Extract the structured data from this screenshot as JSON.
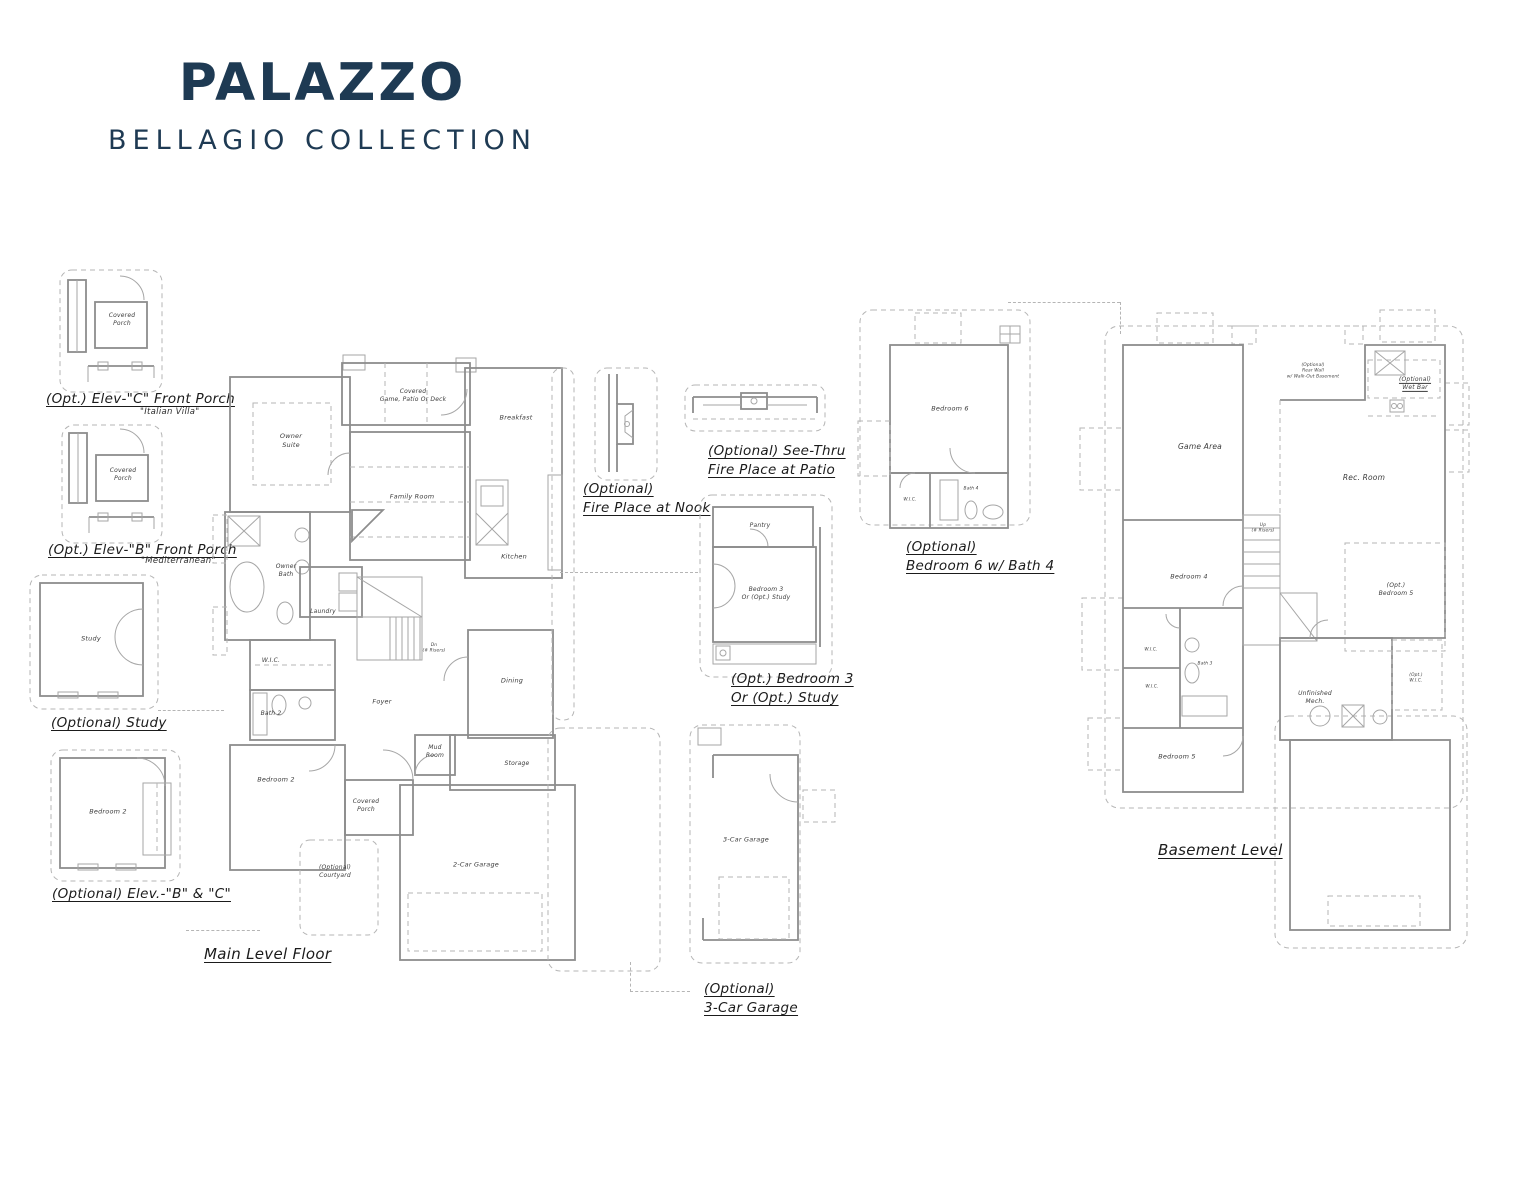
{
  "header": {
    "title": "PALAZZO",
    "subtitle": "BELLAGIO COLLECTION",
    "brand_color": "#1e3a53"
  },
  "captions": {
    "elev_c": "(Opt.) Elev-\"C\" Front Porch",
    "elev_c_style": "\"Italian Villa\"",
    "elev_b": "(Opt.) Elev-\"B\" Front Porch",
    "elev_b_style": "\"Mediterranean\"",
    "study": "(Optional) Study",
    "bedroom2_elev": "(Optional) Elev.-\"B\" & \"C\"",
    "main_level": "Main Level Floor",
    "fireplace_nook": "(Optional)\nFire Place at Nook",
    "fireplace_patio": "(Optional) See-Thru\nFire Place at Patio",
    "bedroom3": "(Opt.) Bedroom 3\nOr (Opt.) Study",
    "garage3": "(Optional)\n3-Car Garage",
    "bedroom6": "(Optional)\nBedroom 6 w/ Bath 4",
    "basement": "Basement Level"
  },
  "rooms": {
    "porch_c": "Covered\nPorch",
    "porch_b": "Covered\nPorch",
    "study": "Study",
    "bedroom2_opt": "Bedroom 2",
    "owner_suite": "Owner\nSuite",
    "covered_game_patio": "Covered\nGame, Patio Or Deck",
    "breakfast": "Breakfast",
    "family_room": "Family Room",
    "kitchen": "Kitchen",
    "owner_bath": "Owner\nBath",
    "laundry": "Laundry",
    "wic_main": "W.I.C.",
    "bath2": "Bath 2",
    "foyer": "Foyer",
    "stairs_dn": "Dn\n(# Risers)",
    "dining": "Dining",
    "bedroom2_main": "Bedroom 2",
    "mud_room": "Mud\nRoom",
    "storage": "Storage",
    "covered_porch": "Covered\nPorch",
    "courtyard": "(Optional)\nCourtyard",
    "garage2": "2-Car Garage",
    "pantry": "Pantry",
    "bedroom3": "Bedroom 3\nOr (Opt.) Study",
    "garage3": "3-Car Garage",
    "bedroom6": "Bedroom 6",
    "wic_bed6": "W.I.C.",
    "bath4": "Bath 4",
    "game_area": "Game Area",
    "rec_room": "Rec. Room",
    "wet_bar": "(Optional)\nWet Bar",
    "walkout_note": "(Optional)\nRear Wall\nw/ Walk-Out Basement",
    "stairs_up": "Up\n(# Risers)",
    "bedroom4": "Bedroom 4",
    "bedroom5_opt": "(Opt.)\nBedroom 5",
    "wic_bsmt_a": "W.I.C.",
    "bath3": "Bath 3",
    "wic_bsmt_b": "W.I.C.",
    "unfinished_mech": "Unfinished\nMech.",
    "wic_opt": "(Opt.)\nW.I.C.",
    "bedroom5": "Bedroom 5"
  }
}
